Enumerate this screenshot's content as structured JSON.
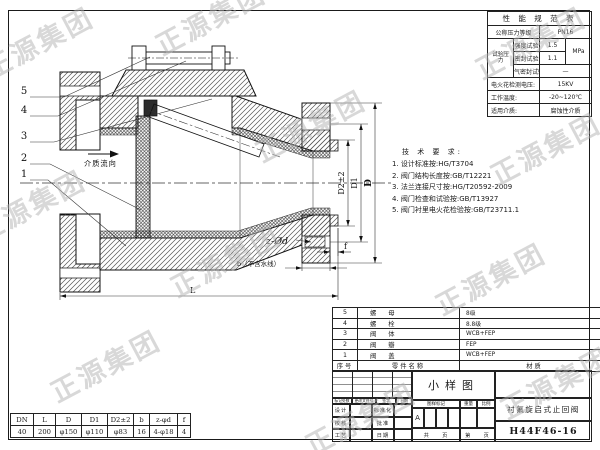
{
  "watermark": {
    "text": "正源集团"
  },
  "drawing": {
    "balloons": [
      "5",
      "4",
      "3",
      "2",
      "1"
    ],
    "flow_label": "介质流向",
    "labels": {
      "z_holes": "z-Ød",
      "b": "b（不含水线）",
      "f": "f",
      "L": "L",
      "D": "D",
      "D1": "D1",
      "D2": "D2±2"
    }
  },
  "spec_table": {
    "title": "性 能 规 范 表",
    "pn_label": "公称压力等级",
    "pn_value": "PN16",
    "test_label": "试验压力",
    "strength_label": "强度试验",
    "strength_value": "1.5",
    "seal_label": "密封试验",
    "seal_value": "1.1",
    "air_label": "气密封试验",
    "air_value": "—",
    "unit": "MPa",
    "spark_label": "电火花检测电压:",
    "spark_value": "15KV",
    "temp_label": "工作温度:",
    "temp_value": "-20~120℃",
    "medium_label": "适用介质:",
    "medium_value": "腐蚀性介质"
  },
  "tech_requirements": {
    "title": "技 术 要 求:",
    "items": [
      "1. 设计标准按:HG/T3704",
      "2. 阀门结构长度按:GB/T12221",
      "3. 法兰连接尺寸按:HG/T20592-2009",
      "4. 阀门检查和试验按:GB/T13927",
      "5. 阀门衬里电火花检验按:GB/T23711.1"
    ]
  },
  "parts_list": {
    "headers": {
      "no": "序号",
      "name": "零件名称",
      "material": "材质"
    },
    "rows": [
      {
        "no": "5",
        "name": "螺 母",
        "material": "8级"
      },
      {
        "no": "4",
        "name": "螺 栓",
        "material": "8.8级"
      },
      {
        "no": "3",
        "name": "阀 体",
        "material": "WCB+FEP"
      },
      {
        "no": "2",
        "name": "阀 瓣",
        "material": "FEP"
      },
      {
        "no": "1",
        "name": "阀 盖",
        "material": "WCB+FEP"
      }
    ]
  },
  "title_block": {
    "rev_header": [
      "标记处数",
      "更改文件号",
      "签字",
      "日期"
    ],
    "sign_rows": [
      {
        "l1": "设计",
        "l2": "标准化"
      },
      {
        "l1": "校核",
        "l2": "批准"
      },
      {
        "l1": "工艺",
        "l2": "日期"
      }
    ],
    "sample_label": "小样图",
    "mark_label": "图样标记",
    "weight_label": "重量",
    "scale_label": "比例",
    "mark_value": "A",
    "pages_total": "共　　页",
    "pages_current": "第　　页",
    "product_name": "衬氟旋启式止回阀",
    "model": "H44F46-16"
  },
  "dim_table": {
    "headers": [
      "DN",
      "L",
      "D",
      "D1",
      "D2±2",
      "b",
      "z-φd",
      "f"
    ],
    "values": [
      "40",
      "200",
      "φ150",
      "φ110",
      "φ83",
      "16",
      "4-φ18",
      "4"
    ]
  }
}
